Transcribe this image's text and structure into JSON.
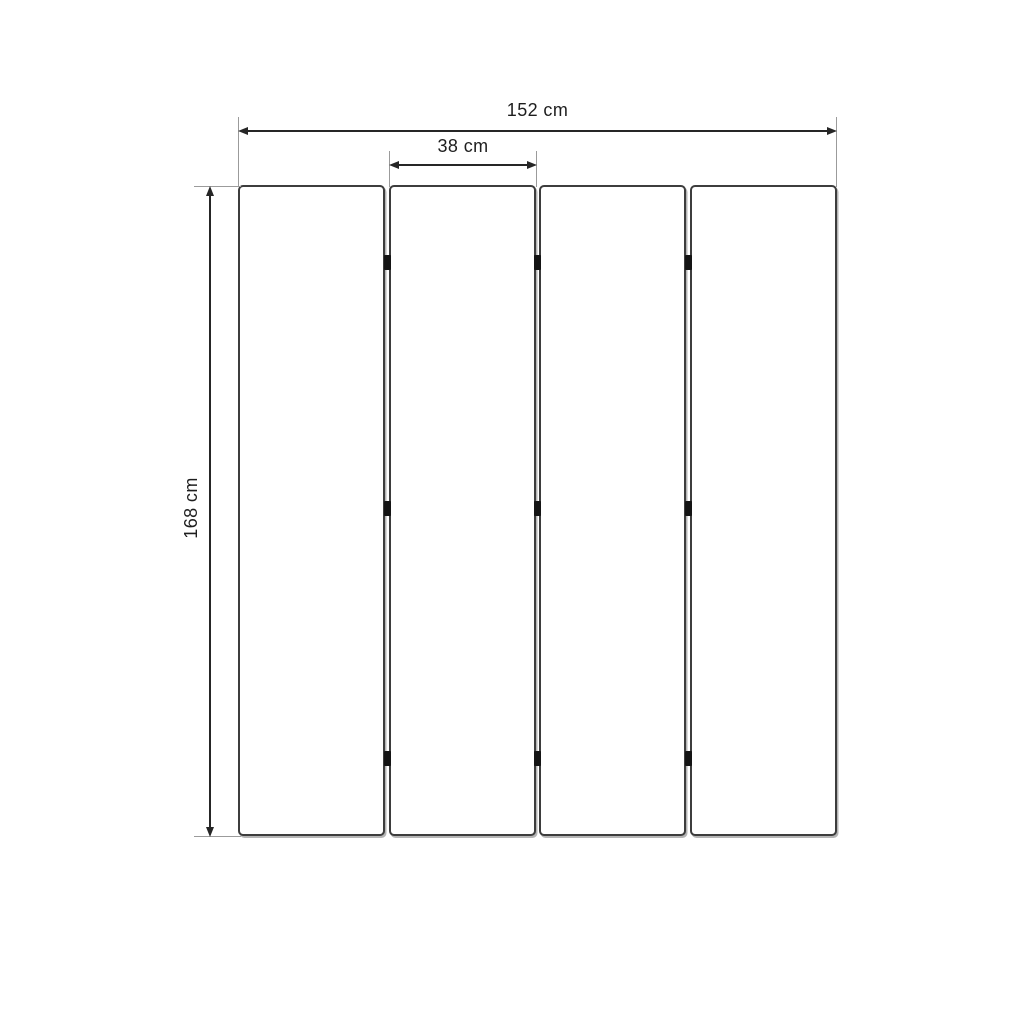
{
  "diagram": {
    "kind": "dimensional-drawing",
    "panel_count": 4,
    "hinges_per_junction": 3
  },
  "dimensions": {
    "total_width": {
      "label": "152 cm",
      "value": 152,
      "unit": "cm"
    },
    "panel_width": {
      "label": "38 cm",
      "value": 38,
      "unit": "cm"
    },
    "height": {
      "label": "168 cm",
      "value": 168,
      "unit": "cm"
    }
  },
  "colors": {
    "background": "#ffffff",
    "panel_fill": "#ffffff",
    "panel_border": "#3d3d3d",
    "dimension_line": "#262626",
    "extension_line": "#9b9b9b",
    "hinge": "#141414",
    "text": "#1e1e1e"
  }
}
